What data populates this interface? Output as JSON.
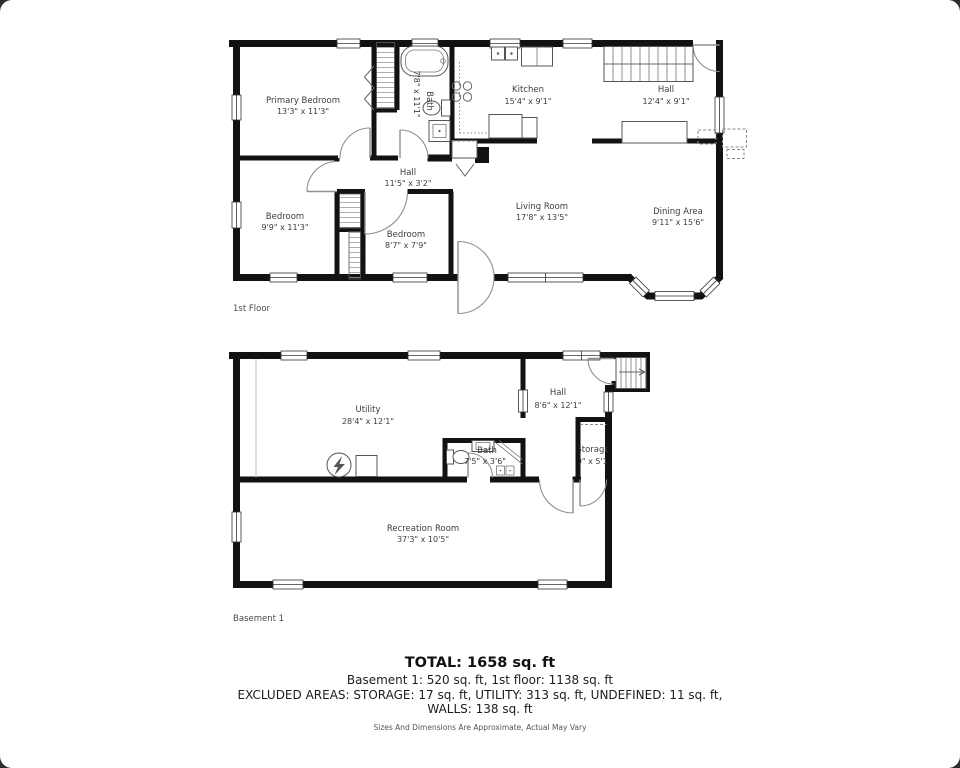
{
  "frame": {
    "background": "#ffffff",
    "wall_color": "#121212",
    "label_color": "#3d3d3d"
  },
  "first_floor": {
    "floor_label": "1st Floor",
    "rooms": {
      "primary_bedroom": {
        "name": "Primary Bedroom",
        "dims": "13'3\" x 11'3\""
      },
      "bath": {
        "name": "Bath",
        "dims": "7'8\" x 11'1\""
      },
      "kitchen": {
        "name": "Kitchen",
        "dims": "15'4\" x 9'1\""
      },
      "hall_upper": {
        "name": "Hall",
        "dims": "12'4\" x 9'1\""
      },
      "hall_middle": {
        "name": "Hall",
        "dims": "11'5\" x 3'2\""
      },
      "bedroom_left": {
        "name": "Bedroom",
        "dims": "9'9\" x 11'3\""
      },
      "bedroom_middle": {
        "name": "Bedroom",
        "dims": "8'7\" x 7'9\""
      },
      "living_room": {
        "name": "Living Room",
        "dims": "17'8\" x 13'5\""
      },
      "dining_area": {
        "name": "Dining Area",
        "dims": "9'11\" x 15'6\""
      }
    }
  },
  "basement": {
    "floor_label": "Basement 1",
    "rooms": {
      "utility": {
        "name": "Utility",
        "dims": "28'4\" x 12'1\""
      },
      "hall": {
        "name": "Hall",
        "dims": "8'6\" x 12'1\""
      },
      "bath": {
        "name": "Bath",
        "dims": "7'5\" x 3'6\""
      },
      "storage": {
        "name": "Storage",
        "dims": "3'0\" x 5'10\""
      },
      "recreation_room": {
        "name": "Recreation Room",
        "dims": "37'3\" x 10'5\""
      }
    }
  },
  "summary": {
    "total": "TOTAL: 1658 sq. ft",
    "floors": "Basement 1: 520 sq. ft, 1st floor: 1138 sq. ft",
    "excluded_line1": "EXCLUDED AREAS: STORAGE: 17 sq. ft, UTILITY: 313 sq. ft, UNDEFINED: 11 sq. ft,",
    "excluded_line2": "WALLS: 138 sq. ft",
    "disclaimer": "Sizes And Dimensions Are Approximate, Actual May Vary"
  }
}
